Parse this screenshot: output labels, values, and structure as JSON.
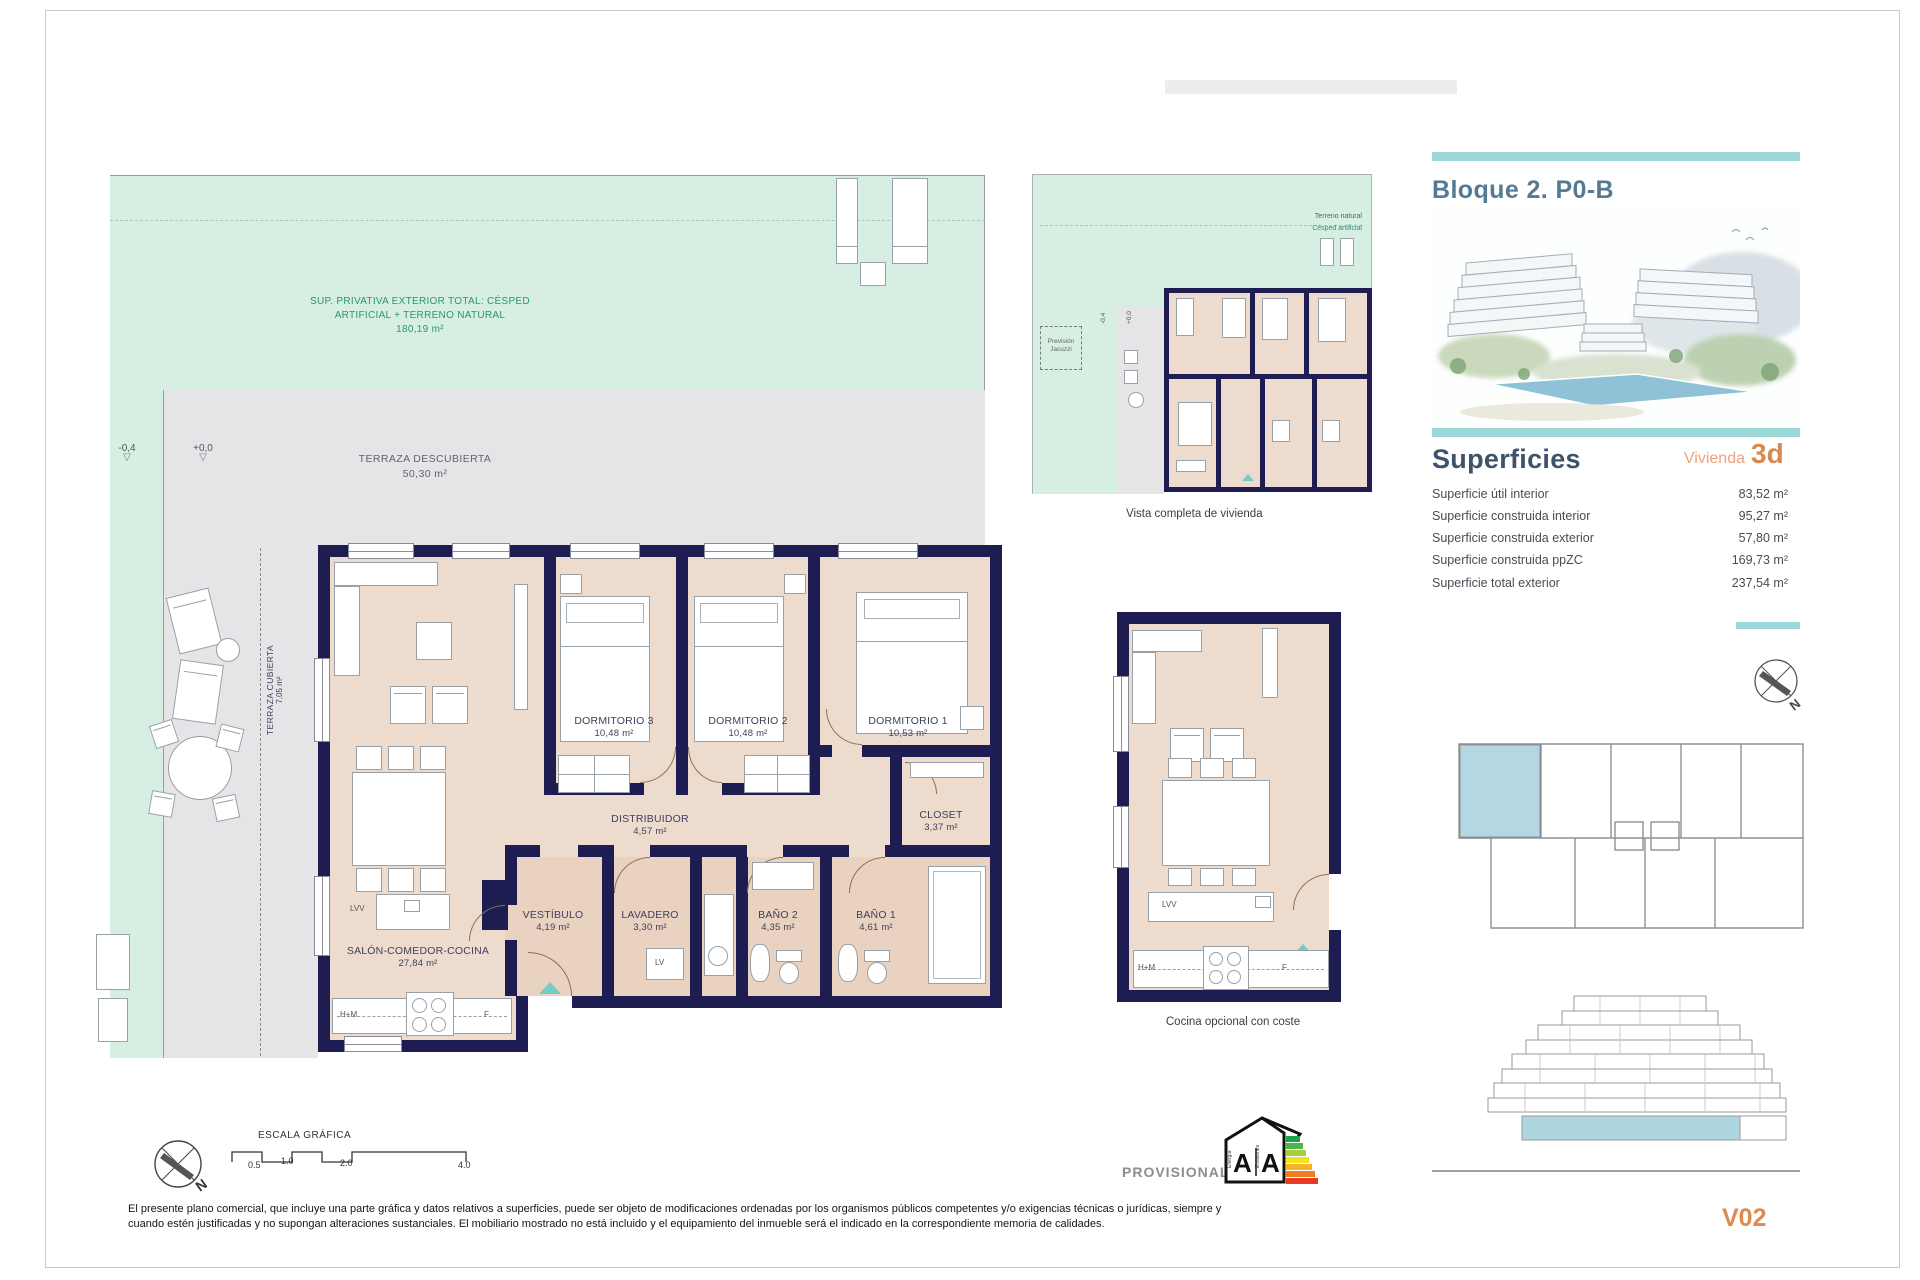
{
  "colors": {
    "wall_navy": "#1d1d52",
    "room_beige": "#eddccd",
    "exterior_green": "#d6efe2",
    "terrace_gray": "#e5e5e7",
    "accent_teal": "#9ed8d8",
    "accent_orange": "#d8894f",
    "title_blue": "#557a92"
  },
  "plan": {
    "exterior_label_line1": "SUP. PRIVATIVA EXTERIOR TOTAL: CÉSPED",
    "exterior_label_line2": "ARTIFICIAL + TERRENO NATURAL",
    "exterior_label_area": "180,19 m²",
    "terraza_descubierta_name": "TERRAZA DESCUBIERTA",
    "terraza_descubierta_area": "50,30 m²",
    "terraza_cubierta_name": "TERRAZA CUBIERTA",
    "terraza_cubierta_area": "7,05 m²",
    "level_minus": "-0,4",
    "level_plus": "+0,0",
    "level_triangle": "▽",
    "rooms": {
      "salon": {
        "name": "SALÓN-COMEDOR-COCINA",
        "area": "27,84 m²"
      },
      "dorm3": {
        "name": "DORMITORIO 3",
        "area": "10,48 m²"
      },
      "dorm2": {
        "name": "DORMITORIO 2",
        "area": "10,48 m²"
      },
      "dorm1": {
        "name": "DORMITORIO 1",
        "area": "10,53 m²"
      },
      "distribuidor": {
        "name": "DISTRIBUIDOR",
        "area": "4,57 m²"
      },
      "closet": {
        "name": "CLOSET",
        "area": "3,37 m²"
      },
      "vestibulo": {
        "name": "VESTÍBULO",
        "area": "4,19 m²"
      },
      "lavadero": {
        "name": "LAVADERO",
        "area": "3,30 m²"
      },
      "bano2": {
        "name": "BAÑO 2",
        "area": "4,35 m²"
      },
      "bano1": {
        "name": "BAÑO 1",
        "area": "4,61 m²"
      }
    },
    "labels": {
      "lvv": "LVV",
      "lv": "LV",
      "hm": "H+M",
      "f": "F"
    }
  },
  "overview": {
    "caption": "Vista completa de vivienda",
    "terreno_natural": "Terreno natural",
    "cesped_artificial": "Césped artificial",
    "jacuzzi_line1": "Previsión",
    "jacuzzi_line2": "Jacuzzi",
    "level_minus": "-0,4",
    "level_plus": "+0,0"
  },
  "kitchen_option": {
    "caption": "Cocina opcional con coste",
    "lvv": "LVV",
    "hm": "H+M",
    "f": "F"
  },
  "sidebar": {
    "block_title": "Bloque 2. P0-B",
    "superficies_title": "Superficies",
    "vivienda_label": "Vivienda",
    "vivienda_code": "3d",
    "rows": [
      {
        "label": "Superficie útil interior",
        "value": "83,52 m²"
      },
      {
        "label": "Superficie construida interior",
        "value": "95,27 m²"
      },
      {
        "label": "Superficie construida exterior",
        "value": "57,80 m²"
      },
      {
        "label": "Superficie construida ppZC",
        "value": "169,73 m²"
      },
      {
        "label": "Superficie total exterior",
        "value": "237,54 m²"
      }
    ],
    "compass_n": "N",
    "version": "V02"
  },
  "footer": {
    "compass_n": "N",
    "scale_title": "ESCALA GRÁFICA",
    "scale_ticks": [
      "0.5",
      "1.0",
      "2.0",
      "4.0"
    ],
    "provisional": "PROVISIONAL",
    "energy_letter_left": "A",
    "energy_letter_right": "A",
    "energy_word_left": "Energía",
    "energy_word_right": "Emisiones",
    "disclaimer_line1": "El presente plano comercial, que incluye una parte gráfica y datos relativos a superficies, puede ser objeto de modificaciones ordenadas por los organismos públicos competentes y/o exigencias técnicas o jurídicas, siempre y",
    "disclaimer_line2": "cuando estén justificadas y no supongan alteraciones sustanciales. El mobiliario mostrado no está incluido y el equipamiento del inmueble será el indicado en la correspondiente memoria de calidades."
  }
}
